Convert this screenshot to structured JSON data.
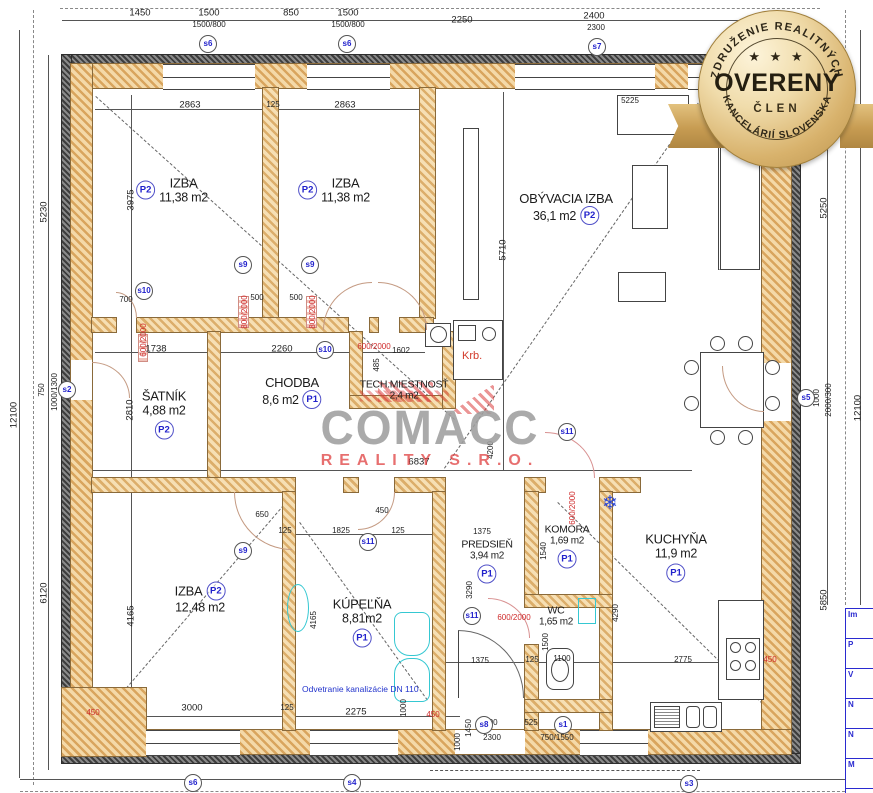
{
  "watermark": {
    "brand": "COMACC",
    "sub": "REALITY S.R.O."
  },
  "seal": {
    "arc_top": "ZDRUŽENIE REALITNÝCH",
    "stars": "★ ★ ★",
    "title": "OVERENÝ",
    "subtitle": "ČLEN",
    "arc_bottom": "KANCELÁRIÍ SLOVENSKA"
  },
  "notes": {
    "vent": "Odvetranie kanalizácie DN 110",
    "fireplace": "Krb."
  },
  "titleblock": {
    "rows": [
      "Im",
      "P",
      "V",
      "N",
      "N",
      "M"
    ]
  },
  "rooms": [
    {
      "name": "IZBA",
      "area": "11,38 m2",
      "cls": "P2",
      "bp": "left",
      "x": 172,
      "y": 190
    },
    {
      "name": "IZBA",
      "area": "11,38 m2",
      "cls": "P2",
      "bp": "left",
      "x": 334,
      "y": 190
    },
    {
      "name": "OBÝVACIA IZBA",
      "area": "36,1 m2",
      "cls": "P2",
      "bp": "area",
      "x": 566,
      "y": 208
    },
    {
      "name": "ŠATNÍK",
      "area": "4,88 m2",
      "cls": "P2",
      "bp": "below",
      "x": 164,
      "y": 414
    },
    {
      "name": "CHODBA",
      "area": "8,6 m2",
      "cls": "P1",
      "bp": "area",
      "x": 292,
      "y": 392
    },
    {
      "name": "TECH.MIESTNOSŤ",
      "area": "2,4 m2",
      "cls": "",
      "bp": "none",
      "x": 404,
      "y": 390,
      "sm": 1,
      "hl": 1
    },
    {
      "name": "IZBA",
      "area": "12,48 m2",
      "cls": "P2",
      "bp": "name",
      "x": 200,
      "y": 598
    },
    {
      "name": "KÚPEĽŇA",
      "area": "8,81m2",
      "cls": "P1",
      "bp": "below",
      "x": 362,
      "y": 622
    },
    {
      "name": "PREDSIEŇ",
      "area": "3,94 m2",
      "cls": "P1",
      "bp": "below",
      "x": 487,
      "y": 561,
      "sm": 1
    },
    {
      "name": "KOMORA",
      "area": "1,69 m2",
      "cls": "P1",
      "bp": "below",
      "x": 567,
      "y": 546,
      "sm": 1
    },
    {
      "name": "WC",
      "area": "1,65 m2",
      "cls": "",
      "bp": "none",
      "x": 556,
      "y": 616,
      "sm": 1
    },
    {
      "name": "KUCHYŇA",
      "area": "11,9 m2",
      "cls": "P1",
      "bp": "below",
      "x": 676,
      "y": 557
    }
  ],
  "s_badges": [
    {
      "l": "s6",
      "x": 208,
      "y": 44
    },
    {
      "l": "s6",
      "x": 347,
      "y": 44
    },
    {
      "l": "s7",
      "x": 597,
      "y": 47
    },
    {
      "l": "s2",
      "x": 67,
      "y": 390
    },
    {
      "l": "s5",
      "x": 806,
      "y": 398
    },
    {
      "l": "s10",
      "x": 144,
      "y": 291
    },
    {
      "l": "s10",
      "x": 325,
      "y": 350
    },
    {
      "l": "s9",
      "x": 243,
      "y": 265
    },
    {
      "l": "s9",
      "x": 310,
      "y": 265
    },
    {
      "l": "s9",
      "x": 243,
      "y": 551
    },
    {
      "l": "s11",
      "x": 368,
      "y": 542
    },
    {
      "l": "s11",
      "x": 567,
      "y": 432
    },
    {
      "l": "s11",
      "x": 472,
      "y": 616
    },
    {
      "l": "s8",
      "x": 484,
      "y": 725
    },
    {
      "l": "s1",
      "x": 563,
      "y": 725
    },
    {
      "l": "s6",
      "x": 193,
      "y": 783
    },
    {
      "l": "s4",
      "x": 352,
      "y": 783
    },
    {
      "l": "s3",
      "x": 689,
      "y": 784
    }
  ],
  "dims": [
    {
      "t": "1450",
      "x": 140,
      "y": 13
    },
    {
      "t": "1500",
      "x": 209,
      "y": 13
    },
    {
      "t": "1500/800",
      "x": 209,
      "y": 25,
      "s": 1
    },
    {
      "t": "850",
      "x": 291,
      "y": 13
    },
    {
      "t": "1500",
      "x": 348,
      "y": 13
    },
    {
      "t": "1500/800",
      "x": 348,
      "y": 25,
      "s": 1
    },
    {
      "t": "2250",
      "x": 462,
      "y": 20
    },
    {
      "t": "2400",
      "x": 594,
      "y": 16
    },
    {
      "t": "2300",
      "x": 596,
      "y": 28,
      "s": 1
    },
    {
      "t": "12100",
      "x": 14,
      "y": 415,
      "r": -90
    },
    {
      "t": "5230",
      "x": 44,
      "y": 212,
      "r": -90
    },
    {
      "t": "750",
      "x": 42,
      "y": 390,
      "r": -90,
      "s": 1
    },
    {
      "t": "1000/1300",
      "x": 55,
      "y": 392,
      "r": -90,
      "s": 1
    },
    {
      "t": "6120",
      "x": 44,
      "y": 593,
      "r": -90
    },
    {
      "t": "5250",
      "x": 824,
      "y": 208,
      "r": -90
    },
    {
      "t": "1000",
      "x": 817,
      "y": 398,
      "r": -90,
      "s": 1
    },
    {
      "t": "2000/300",
      "x": 829,
      "y": 400,
      "r": -90,
      "s": 1
    },
    {
      "t": "12100",
      "x": 858,
      "y": 408,
      "r": -90
    },
    {
      "t": "5850",
      "x": 824,
      "y": 600,
      "r": -90
    },
    {
      "t": "3000",
      "x": 192,
      "y": 708
    },
    {
      "t": "125",
      "x": 287,
      "y": 708,
      "s": 1
    },
    {
      "t": "2275",
      "x": 356,
      "y": 712
    },
    {
      "t": "1000",
      "x": 404,
      "y": 708,
      "r": -90,
      "s": 1
    },
    {
      "t": "450",
      "x": 93,
      "y": 713,
      "s": 1,
      "c": "red"
    },
    {
      "t": "450",
      "x": 433,
      "y": 715,
      "s": 1,
      "c": "red"
    },
    {
      "t": "450",
      "x": 770,
      "y": 660,
      "s": 1,
      "c": "red"
    },
    {
      "t": "1450",
      "x": 469,
      "y": 728,
      "r": -90,
      "s": 1
    },
    {
      "t": "1000",
      "x": 458,
      "y": 742,
      "r": -90,
      "s": 1
    },
    {
      "t": "1100",
      "x": 489,
      "y": 723,
      "s": 1
    },
    {
      "t": "525",
      "x": 531,
      "y": 723,
      "s": 1
    },
    {
      "t": "500",
      "x": 563,
      "y": 723,
      "s": 1
    },
    {
      "t": "2300",
      "x": 492,
      "y": 738,
      "s": 1
    },
    {
      "t": "750/1550",
      "x": 557,
      "y": 738,
      "s": 1
    },
    {
      "t": "2775",
      "x": 683,
      "y": 660,
      "s": 1
    },
    {
      "t": "2863",
      "x": 190,
      "y": 105
    },
    {
      "t": "125",
      "x": 273,
      "y": 105,
      "s": 1
    },
    {
      "t": "2863",
      "x": 345,
      "y": 105
    },
    {
      "t": "5225",
      "x": 630,
      "y": 101,
      "s": 1
    },
    {
      "t": "3975",
      "x": 131,
      "y": 200,
      "r": -90
    },
    {
      "t": "5710",
      "x": 503,
      "y": 250,
      "r": -90
    },
    {
      "t": "1738",
      "x": 156,
      "y": 349
    },
    {
      "t": "2260",
      "x": 282,
      "y": 349
    },
    {
      "t": "2810",
      "x": 130,
      "y": 410,
      "r": -90
    },
    {
      "t": "1602",
      "x": 401,
      "y": 351,
      "s": 1
    },
    {
      "t": "485",
      "x": 377,
      "y": 365,
      "r": -90,
      "s": 1
    },
    {
      "t": "700",
      "x": 126,
      "y": 300,
      "s": 1
    },
    {
      "t": "500",
      "x": 257,
      "y": 298,
      "s": 1
    },
    {
      "t": "500",
      "x": 296,
      "y": 298,
      "s": 1
    },
    {
      "t": "650",
      "x": 262,
      "y": 515,
      "s": 1
    },
    {
      "t": "450",
      "x": 382,
      "y": 511,
      "s": 1
    },
    {
      "t": "1825",
      "x": 341,
      "y": 531,
      "s": 1
    },
    {
      "t": "125",
      "x": 285,
      "y": 531,
      "s": 1
    },
    {
      "t": "125",
      "x": 398,
      "y": 531,
      "s": 1
    },
    {
      "t": "4165",
      "x": 131,
      "y": 616,
      "r": -90
    },
    {
      "t": "4165",
      "x": 314,
      "y": 620,
      "r": -90,
      "s": 1
    },
    {
      "t": "1375",
      "x": 482,
      "y": 532,
      "s": 1
    },
    {
      "t": "3290",
      "x": 470,
      "y": 590,
      "r": -90,
      "s": 1
    },
    {
      "t": "1540",
      "x": 544,
      "y": 551,
      "r": -90,
      "s": 1
    },
    {
      "t": "1500",
      "x": 546,
      "y": 642,
      "r": -90,
      "s": 1
    },
    {
      "t": "1375",
      "x": 480,
      "y": 661,
      "s": 1
    },
    {
      "t": "1100",
      "x": 562,
      "y": 659,
      "s": 1
    },
    {
      "t": "125",
      "x": 532,
      "y": 660,
      "s": 1
    },
    {
      "t": "4290",
      "x": 616,
      "y": 613,
      "r": -90,
      "s": 1
    },
    {
      "t": "6837",
      "x": 419,
      "y": 462
    },
    {
      "t": "4200",
      "x": 491,
      "y": 450,
      "r": -90,
      "s": 1
    },
    {
      "t": "800/2000",
      "x": 245,
      "y": 312,
      "r": -90,
      "s": 1,
      "c": "red"
    },
    {
      "t": "800/2000",
      "x": 313,
      "y": 312,
      "r": -90,
      "s": 1,
      "c": "red"
    },
    {
      "t": "600/2000",
      "x": 144,
      "y": 340,
      "r": -90,
      "s": 1,
      "c": "red"
    },
    {
      "t": "600/2000",
      "x": 374,
      "y": 347,
      "s": 1,
      "c": "red"
    },
    {
      "t": "600/2000",
      "x": 514,
      "y": 618,
      "s": 1,
      "c": "red"
    },
    {
      "t": "600/2000",
      "x": 573,
      "y": 508,
      "r": -90,
      "s": 1,
      "c": "red"
    }
  ]
}
